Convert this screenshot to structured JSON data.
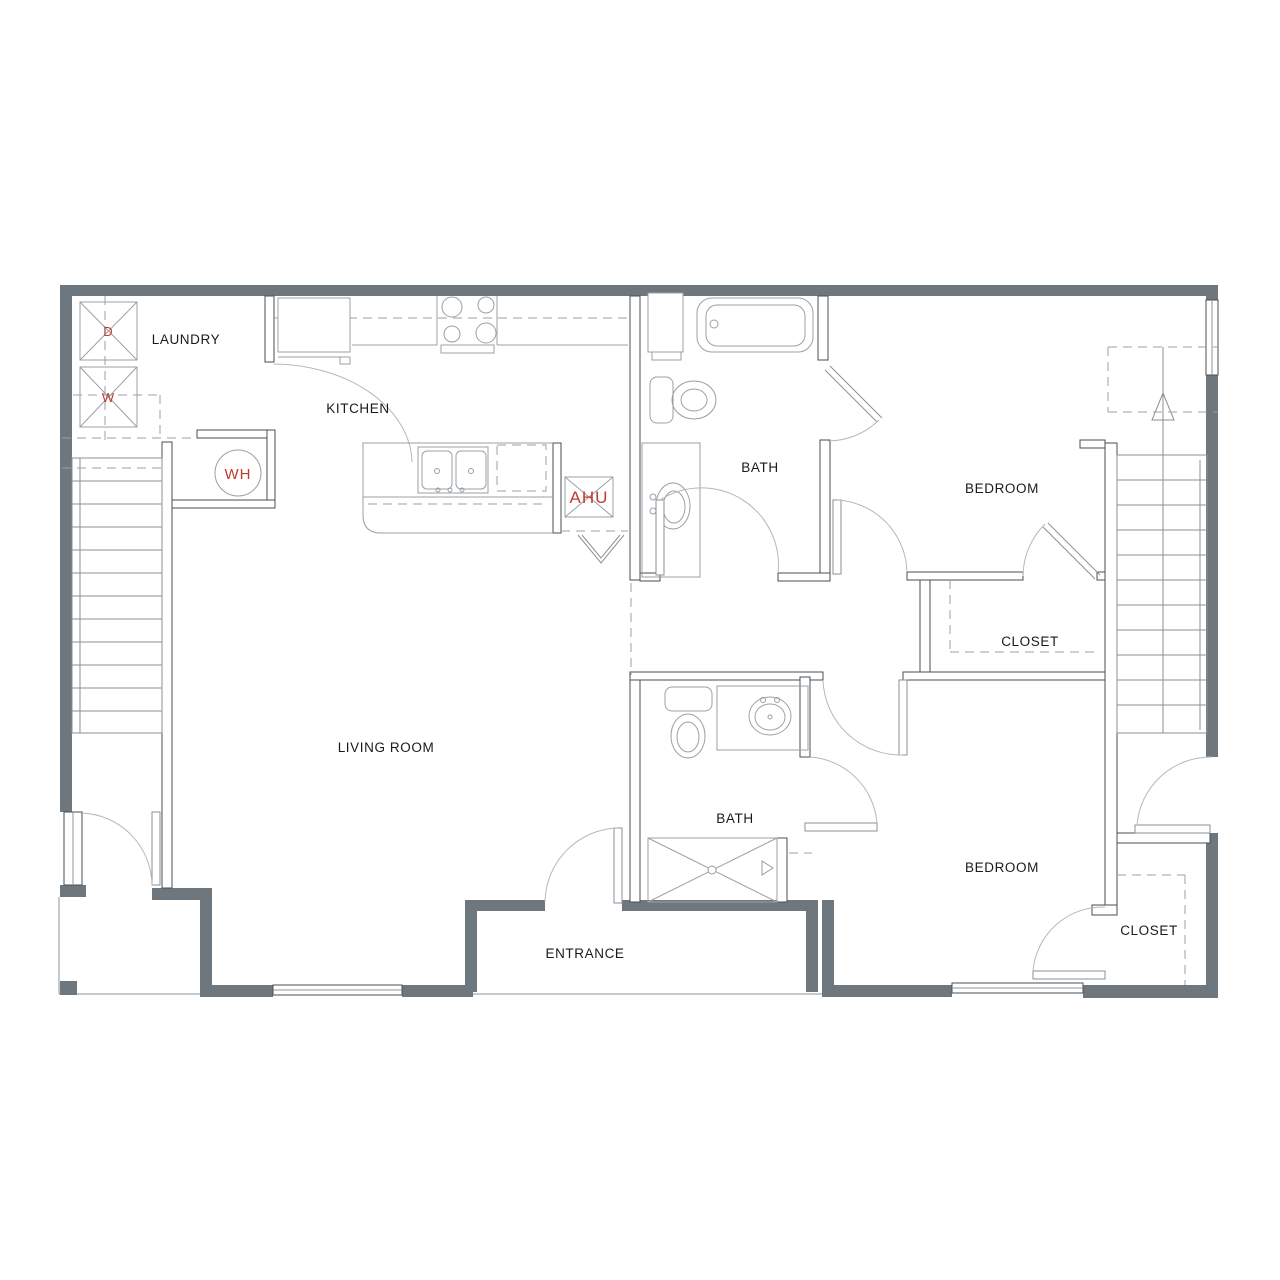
{
  "plan": {
    "title": "Two bedroom two bath apartment floor plan",
    "rooms": [
      {
        "id": "laundry",
        "label": "LAUNDRY"
      },
      {
        "id": "kitchen",
        "label": "KITCHEN"
      },
      {
        "id": "bath-upper",
        "label": "BATH"
      },
      {
        "id": "bedroom-upper",
        "label": "BEDROOM"
      },
      {
        "id": "closet-upper",
        "label": "CLOSET"
      },
      {
        "id": "living-room",
        "label": "LIVING ROOM"
      },
      {
        "id": "bath-lower",
        "label": "BATH"
      },
      {
        "id": "bedroom-lower",
        "label": "BEDROOM"
      },
      {
        "id": "closet-lower",
        "label": "CLOSET"
      },
      {
        "id": "entrance",
        "label": "ENTRANCE"
      }
    ],
    "equipment": [
      {
        "id": "dryer",
        "label": "D"
      },
      {
        "id": "washer",
        "label": "W"
      },
      {
        "id": "water-heater",
        "label": "WH"
      },
      {
        "id": "air-handler",
        "label": "AHU"
      }
    ],
    "colors": {
      "exterior_wall": "#6e767e",
      "interior_line": "#4a4f54",
      "fixture_line": "#9aa0a6",
      "accent_red": "#bf3b2f",
      "background": "#ffffff"
    }
  }
}
